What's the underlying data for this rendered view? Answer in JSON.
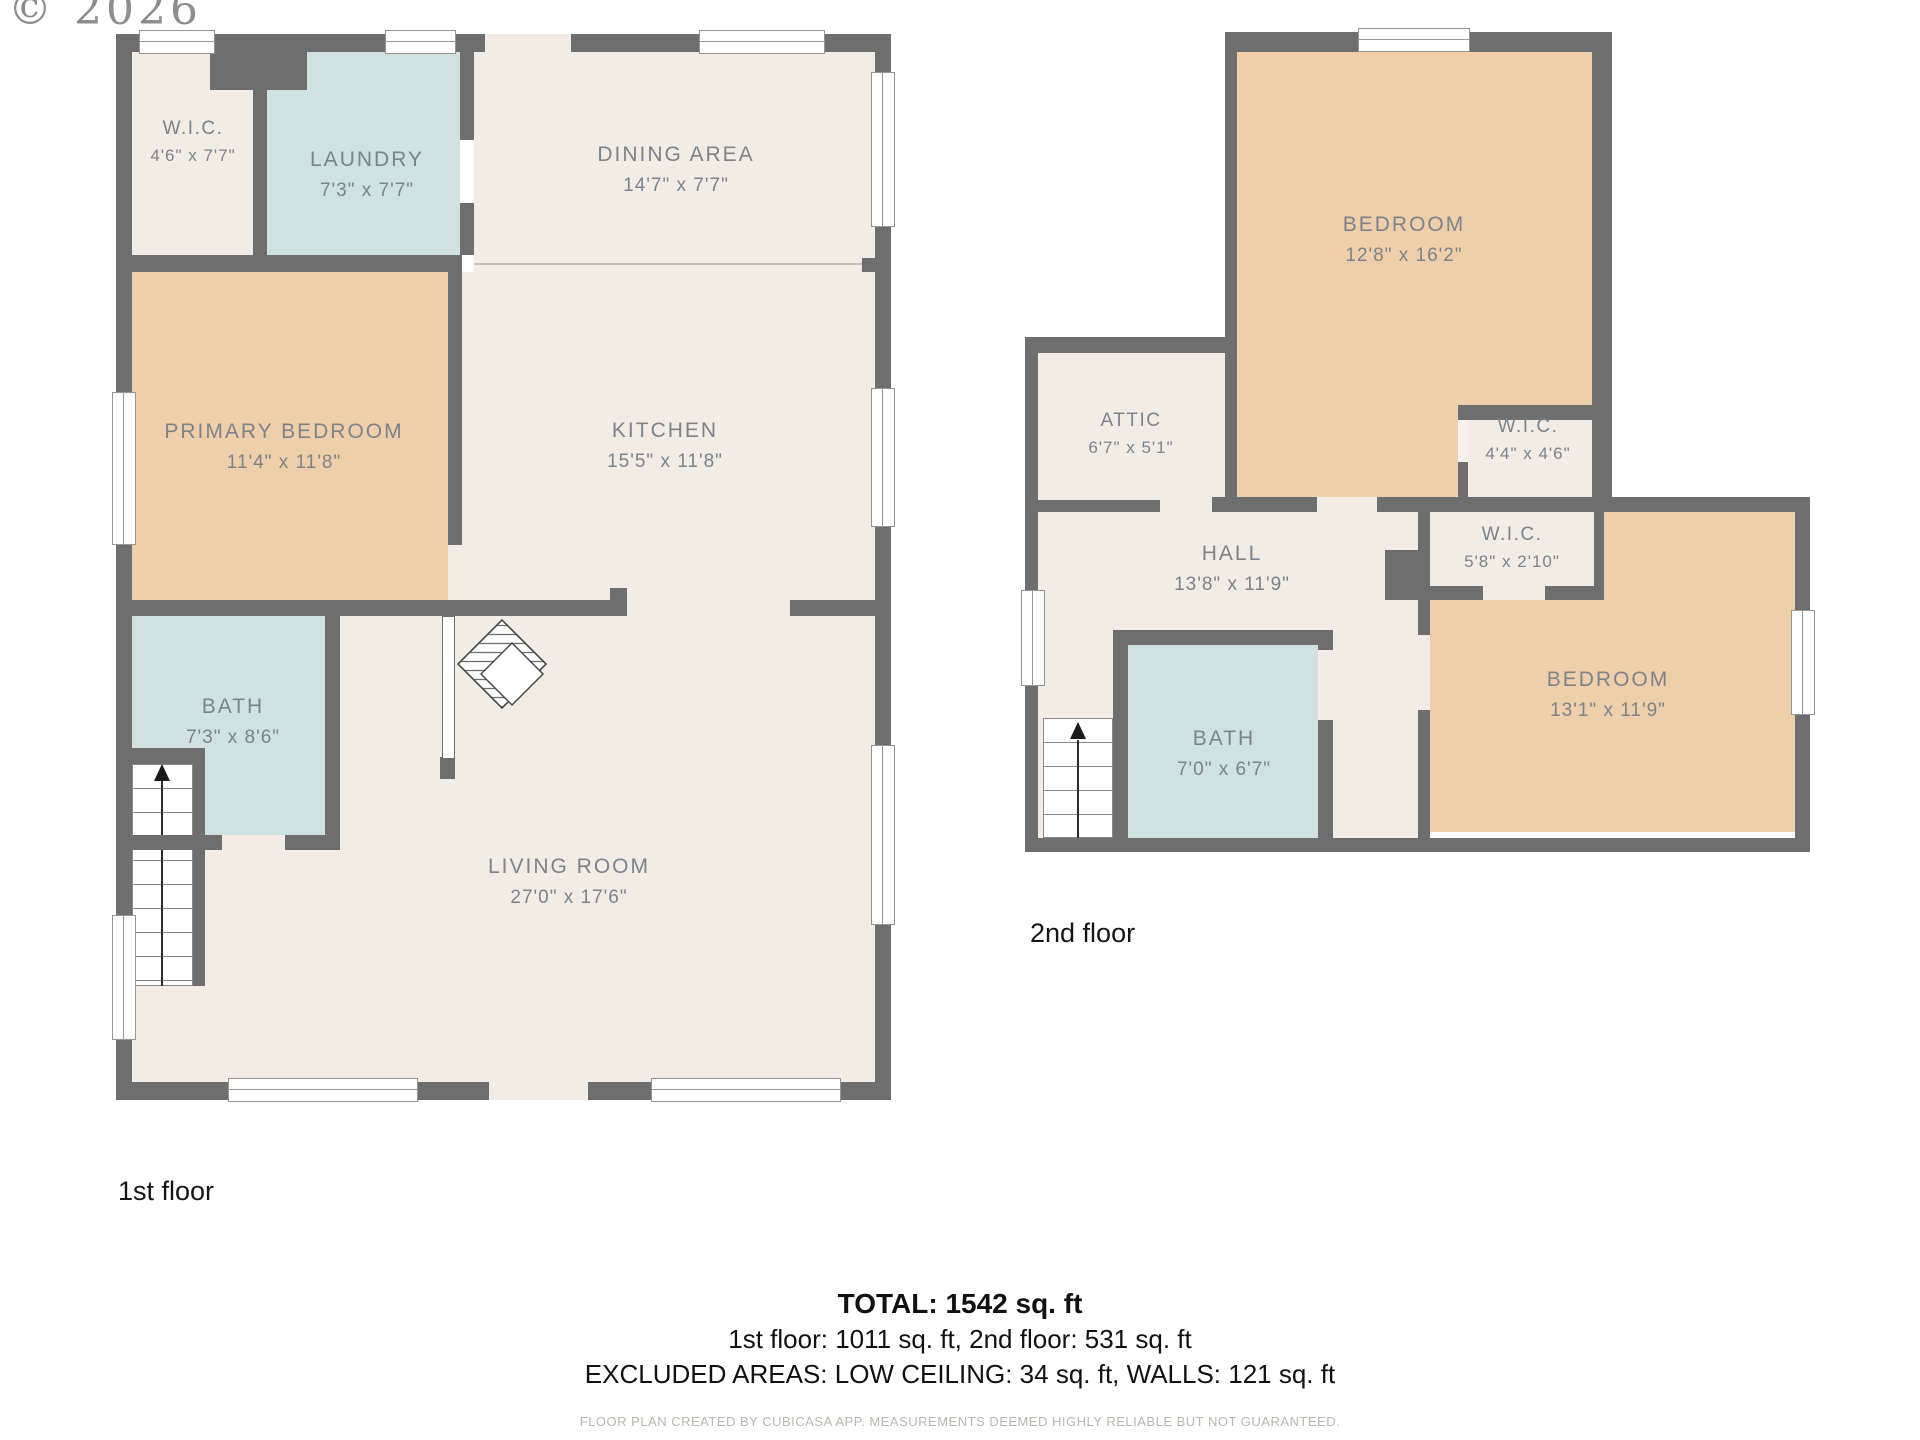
{
  "copyright": "© 2026",
  "floor1": {
    "label": "1st floor",
    "rooms": {
      "wic": {
        "name": "W.I.C.",
        "dims": "4'6\" x 7'7\""
      },
      "laundry": {
        "name": "LAUNDRY",
        "dims": "7'3\" x 7'7\""
      },
      "dining": {
        "name": "DINING AREA",
        "dims": "14'7\" x 7'7\""
      },
      "primary": {
        "name": "PRIMARY BEDROOM",
        "dims": "11'4\" x 11'8\""
      },
      "kitchen": {
        "name": "KITCHEN",
        "dims": "15'5\" x 11'8\""
      },
      "bath": {
        "name": "BATH",
        "dims": "7'3\" x 8'6\""
      },
      "living": {
        "name": "LIVING ROOM",
        "dims": "27'0\" x 17'6\""
      }
    }
  },
  "floor2": {
    "label": "2nd floor",
    "rooms": {
      "bedroom1": {
        "name": "BEDROOM",
        "dims": "12'8\" x 16'2\""
      },
      "attic": {
        "name": "ATTIC",
        "dims": "6'7\" x 5'1\""
      },
      "wic44": {
        "name": "W.I.C.",
        "dims": "4'4\" x 4'6\""
      },
      "hall": {
        "name": "HALL",
        "dims": "13'8\" x 11'9\""
      },
      "wic58": {
        "name": "W.I.C.",
        "dims": "5'8\" x 2'10\""
      },
      "bath": {
        "name": "BATH",
        "dims": "7'0\" x 6'7\""
      },
      "bedroom2": {
        "name": "BEDROOM",
        "dims": "13'1\" x 11'9\""
      }
    }
  },
  "summary": {
    "total": "TOTAL: 1542 sq. ft",
    "floors": "1st floor: 1011 sq. ft, 2nd floor: 531 sq. ft",
    "excluded": "EXCLUDED AREAS: LOW CEILING: 34 sq. ft, WALLS: 121 sq. ft",
    "disclaimer": "FLOOR PLAN CREATED BY CUBICASA APP. MEASUREMENTS DEEMED HIGHLY RELIABLE BUT NOT GUARANTEED."
  },
  "colors": {
    "wall": "#6e6e6e",
    "floor": "#f2ece4",
    "bedroom": "#eecfa9",
    "wet": "#cfe1e1"
  }
}
